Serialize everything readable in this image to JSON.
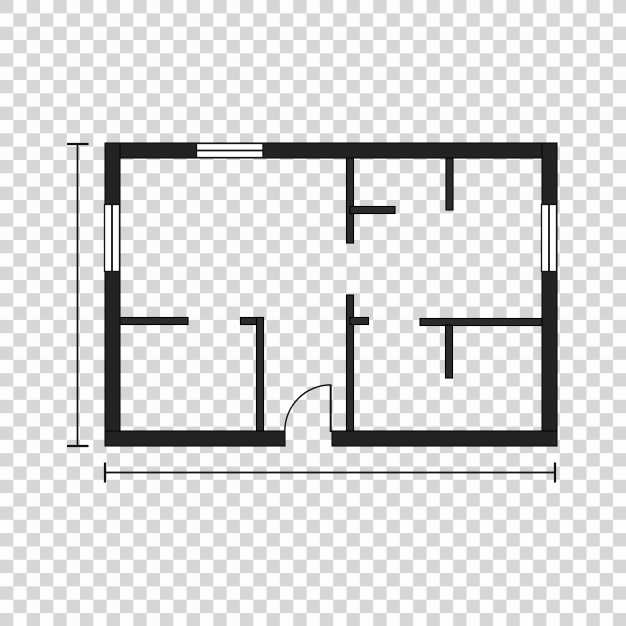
{
  "icon": {
    "name": "floor-plan-icon",
    "kind": "house floor plan vector icon on transparent checkerboard background"
  },
  "colors": {
    "checker_dark": "#d6d6d6",
    "checker_light": "#fdfdfd",
    "wall_fill": "#232323",
    "wall_outline": "#000000",
    "window_fill": "#ffffff",
    "line": "#111111"
  },
  "floor_plan": {
    "outer_bounds": {
      "x": 105,
      "y": 143,
      "width": 452,
      "height": 303,
      "wall_thickness": 15
    },
    "exterior_walls": [
      {
        "name": "exterior-wall-top",
        "x": 105,
        "y": 143,
        "w": 452,
        "h": 15
      },
      {
        "name": "exterior-wall-left",
        "x": 105,
        "y": 143,
        "w": 15,
        "h": 303
      },
      {
        "name": "exterior-wall-right",
        "x": 542,
        "y": 143,
        "w": 15,
        "h": 303
      },
      {
        "name": "exterior-wall-bottom-left",
        "x": 105,
        "y": 431,
        "w": 180,
        "h": 15
      },
      {
        "name": "exterior-wall-bottom-right",
        "x": 332,
        "y": 431,
        "w": 225,
        "h": 15
      }
    ],
    "interior_walls": [
      {
        "name": "partition-top-center-vertical",
        "x": 346.5,
        "y": 158,
        "w": 7,
        "h": 85
      },
      {
        "name": "partition-top-center-stub",
        "x": 350,
        "y": 206.5,
        "w": 45,
        "h": 7
      },
      {
        "name": "partition-top-right-vertical",
        "x": 446,
        "y": 158,
        "w": 7,
        "h": 52
      },
      {
        "name": "partition-left-horizontal",
        "x": 120,
        "y": 317.5,
        "w": 68,
        "h": 7
      },
      {
        "name": "partition-closet-stub",
        "x": 240.5,
        "y": 317.5,
        "w": 23,
        "h": 7
      },
      {
        "name": "partition-closet-vertical",
        "x": 256.5,
        "y": 317.5,
        "w": 7,
        "h": 113.5
      },
      {
        "name": "partition-bottom-center-vertical",
        "x": 346.5,
        "y": 295,
        "w": 7,
        "h": 136
      },
      {
        "name": "partition-bottom-center-stub",
        "x": 350,
        "y": 317.5,
        "w": 18.5,
        "h": 7
      },
      {
        "name": "partition-right-horizontal",
        "x": 420,
        "y": 318.5,
        "w": 122,
        "h": 7
      },
      {
        "name": "partition-right-stub-vertical",
        "x": 445.5,
        "y": 325,
        "w": 7,
        "h": 53
      }
    ],
    "windows": [
      {
        "name": "window-top",
        "x": 196.5,
        "y": 143.5,
        "w": 66.5,
        "h": 14,
        "orientation": "horizontal"
      },
      {
        "name": "window-left",
        "x": 104.5,
        "y": 204.5,
        "w": 15,
        "h": 67,
        "orientation": "vertical"
      },
      {
        "name": "window-right",
        "x": 541.5,
        "y": 204.5,
        "w": 15,
        "h": 67,
        "orientation": "vertical"
      }
    ],
    "door": {
      "leaf": {
        "x1": 330.7,
        "y1": 384.5,
        "x2": 330.7,
        "y2": 432
      },
      "arc_path": "M 284.8 431.3 A 46.3 46.3 0 0 1 330.7 384.8"
    },
    "dimension_lines": [
      {
        "name": "dim-vertical-line",
        "x1": 77.5,
        "y1": 144,
        "x2": 77.5,
        "y2": 446,
        "stroke_width": 1.7
      },
      {
        "name": "dim-vertical-tick-top",
        "x1": 67,
        "y1": 144,
        "x2": 88.5,
        "y2": 144,
        "stroke_width": 2.2
      },
      {
        "name": "dim-vertical-tick-bottom",
        "x1": 67,
        "y1": 446,
        "x2": 88.5,
        "y2": 446,
        "stroke_width": 2.2
      },
      {
        "name": "dim-horizontal-line",
        "x1": 105,
        "y1": 472.5,
        "x2": 555,
        "y2": 472.5,
        "stroke_width": 1.7
      },
      {
        "name": "dim-horizontal-tick-left",
        "x1": 105,
        "y1": 462.5,
        "x2": 105,
        "y2": 482.5,
        "stroke_width": 2.2
      },
      {
        "name": "dim-horizontal-tick-right",
        "x1": 555,
        "y1": 462.5,
        "x2": 555,
        "y2": 482.5,
        "stroke_width": 2.2
      }
    ]
  }
}
